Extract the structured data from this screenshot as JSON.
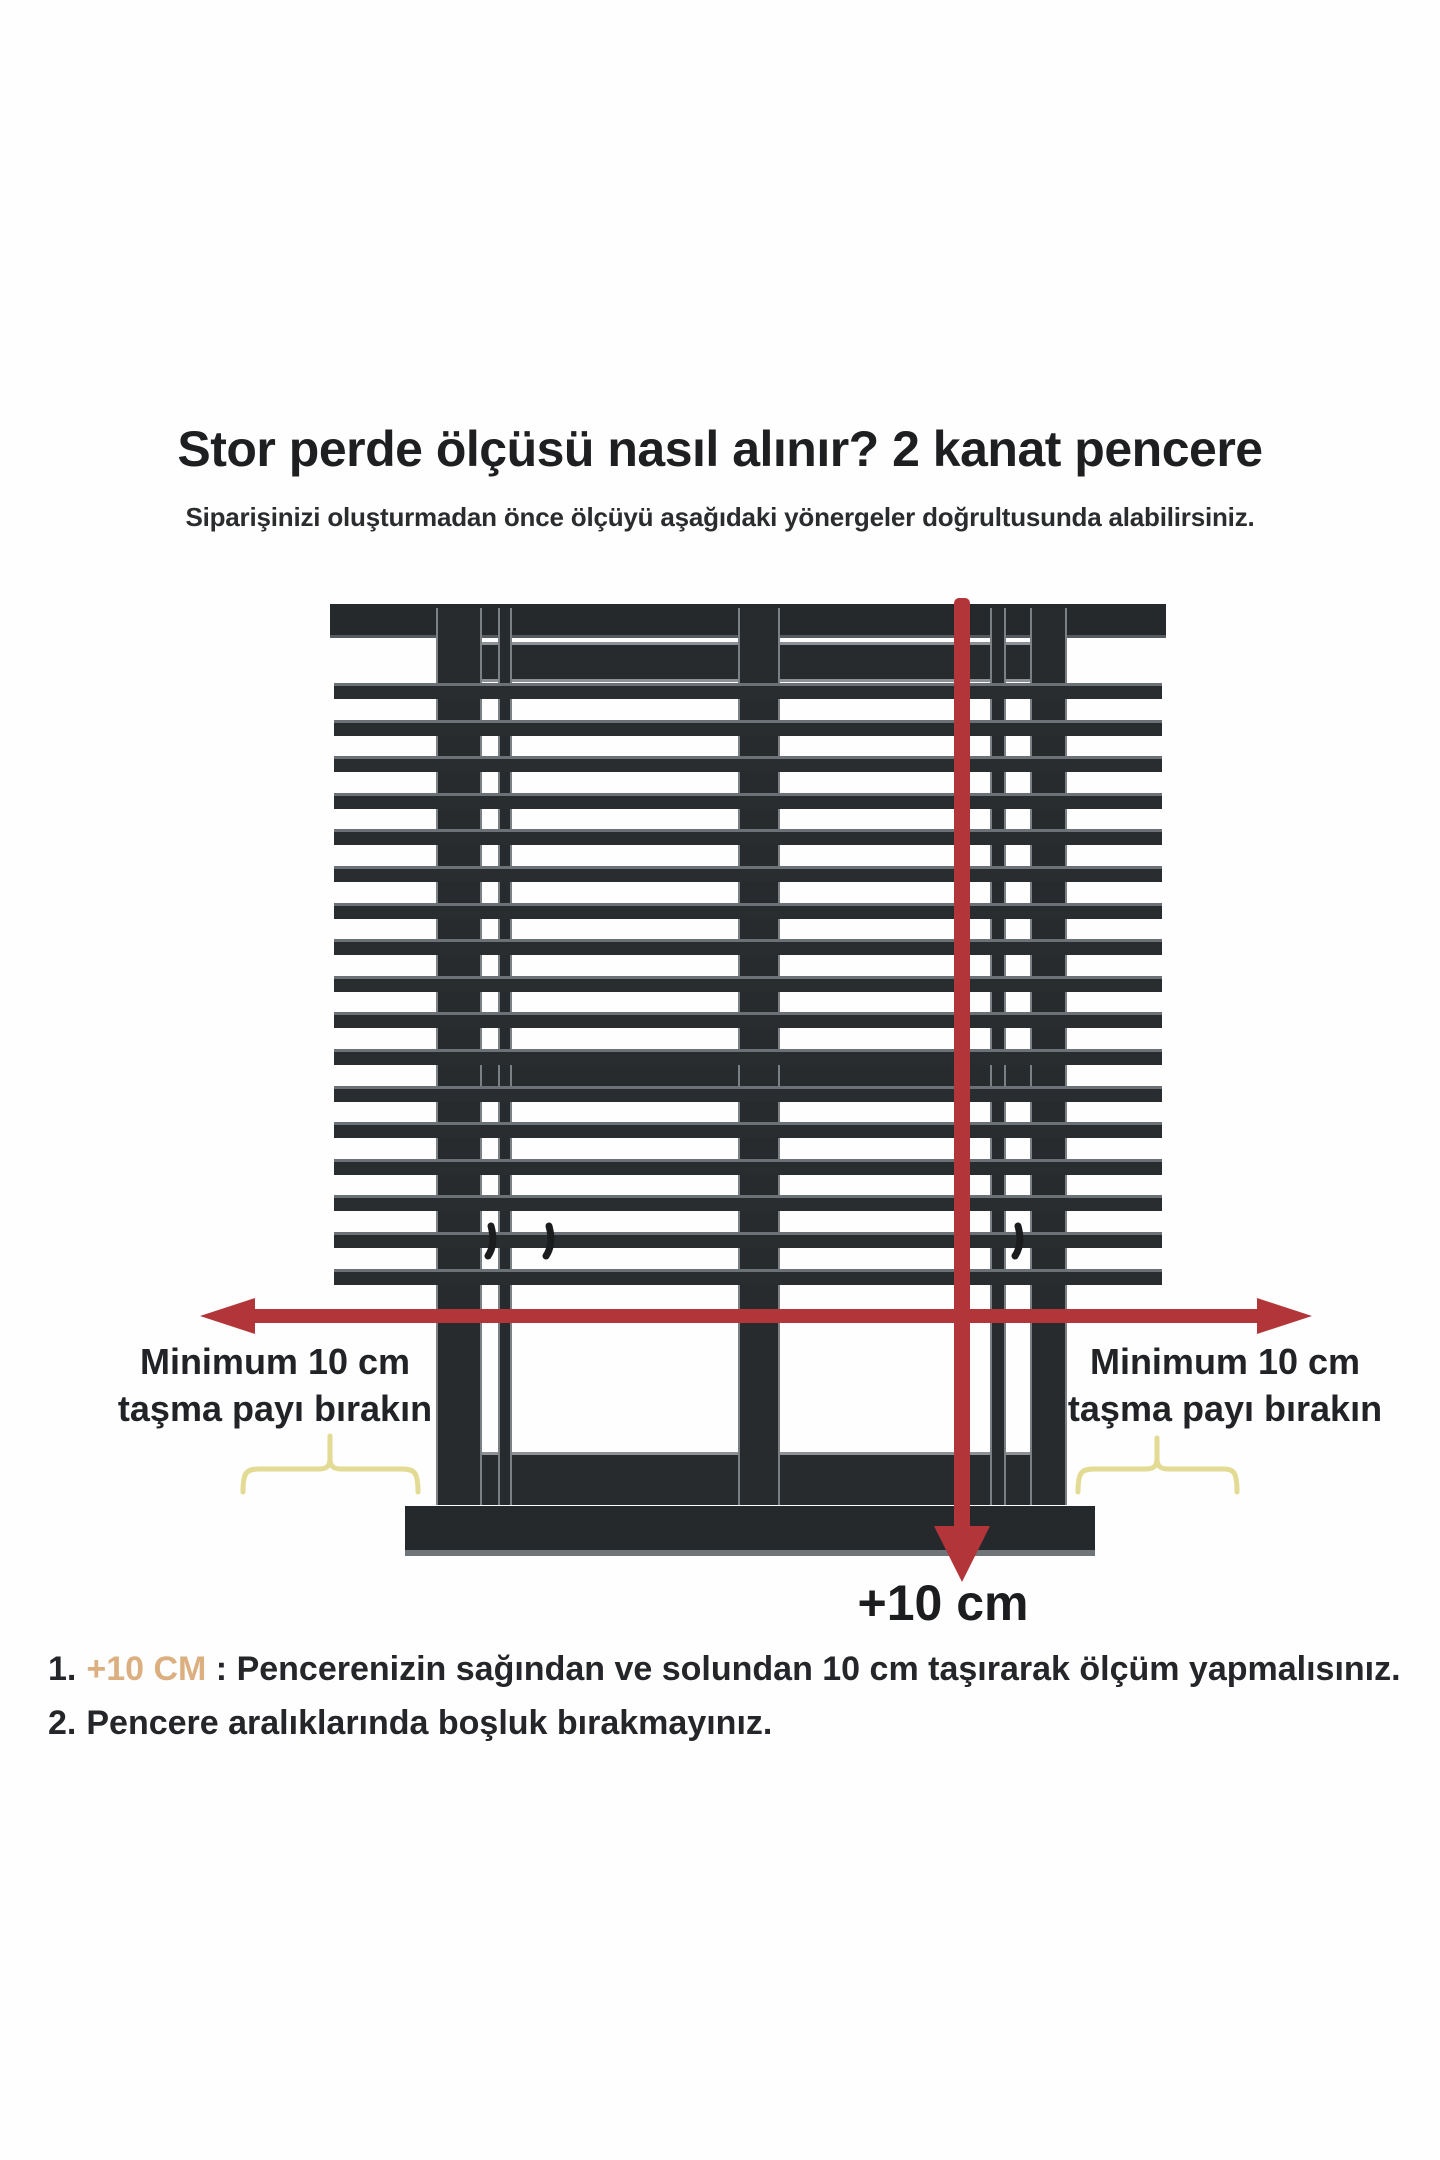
{
  "header": {
    "title": "Stor perde ölçüsü nasıl alınır? 2 kanat pencere",
    "subtitle": "Siparişinizi oluşturmadan önce ölçüyü aşağıdaki yönergeler doğrultusunda alabilirsiniz."
  },
  "diagram": {
    "left_label": {
      "line1": "Minimum 10 cm",
      "line2": "taşma payı bırakın"
    },
    "right_label": {
      "line1": "Minimum 10 cm",
      "line2": "taşma payı bırakın"
    },
    "bottom_arrow_label": "+10 cm"
  },
  "instructions": [
    {
      "number": "1.",
      "highlight": "+10 CM",
      "rest": " : Pencerenizin sağından ve solundan 10 cm taşırarak ölçüm yapmalısınız."
    },
    {
      "number": "2.",
      "highlight": "",
      "rest": "Pencere aralıklarında boşluk bırakmayınız."
    }
  ],
  "colors": {
    "frame_dark": "#282b2e",
    "frame_outline_gray": "#8e9296",
    "measure_red": "#b23639",
    "highlight_tan": "#dcaf80",
    "brace_yellow": "#e3da94",
    "text_dark": "#212326",
    "background": "#fefefe"
  }
}
